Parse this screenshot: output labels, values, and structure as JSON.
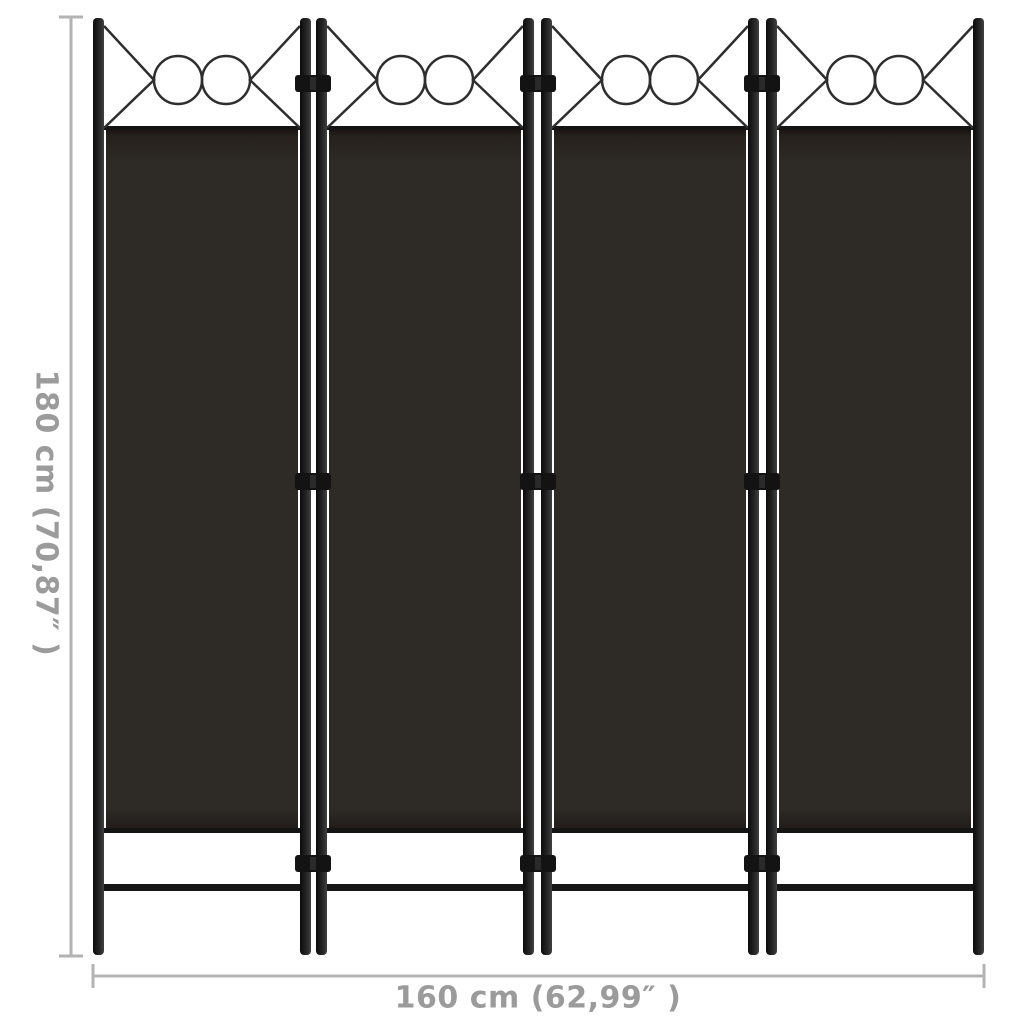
{
  "dimensions": {
    "height_label": "180 cm (70,87″ )",
    "width_label": "160 cm (62,99″ )"
  },
  "figure": {
    "type": "room-divider-product-diagram",
    "panel_count": 4,
    "ornament_circles_per_panel": 2,
    "hinges_per_junction": 3,
    "colors": {
      "background": "#ffffff",
      "fabric": "#2e2a26",
      "fabric_rail": "#141414",
      "frame_dark": "#0b0b0b",
      "frame_mid": "#242424",
      "frame_light": "#414141",
      "ornament_stroke": "#2e2e2e",
      "hinge": "#131313",
      "dimension_line": "#b3b3b3",
      "dimension_text": "#9b9b9b"
    }
  }
}
